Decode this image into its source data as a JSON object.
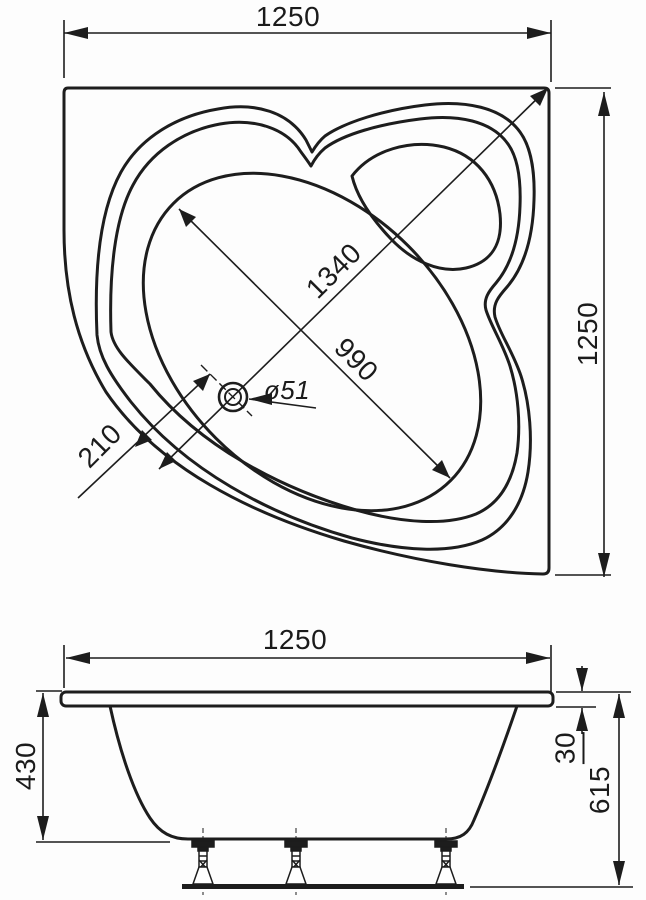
{
  "top_view": {
    "width": "1250",
    "height": "1250",
    "corner_to_front": "1340",
    "bowl_length": "990",
    "drain_offset": "210",
    "drain_diameter": "ø51"
  },
  "side_view": {
    "width": "1250",
    "tub_depth": "430",
    "rim_thickness": "30",
    "total_height": "615"
  }
}
